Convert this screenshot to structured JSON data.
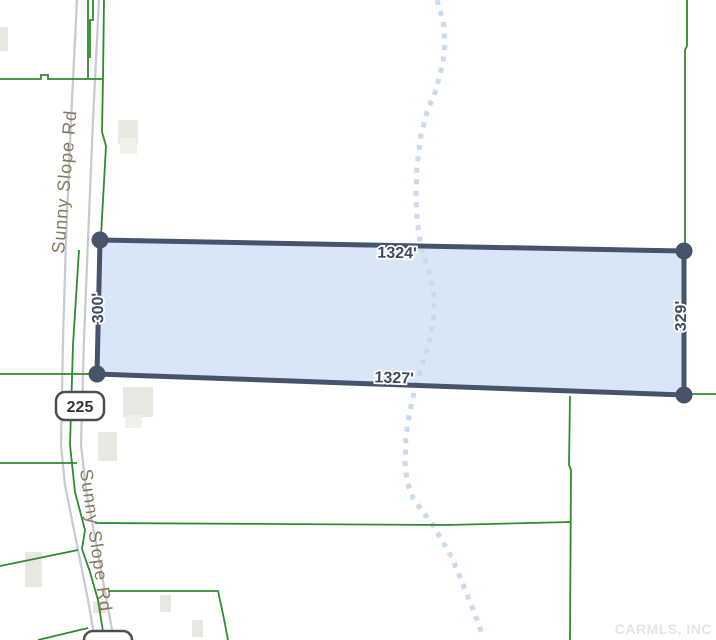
{
  "map_view": {
    "watermark": "CARMLS, INC",
    "parcel": {
      "dim_top": "1324'",
      "dim_bottom": "1327'",
      "dim_left": "300'",
      "dim_right": "329'"
    },
    "road": {
      "name_upper": "Sunny Slope Rd",
      "name_lower": "Sunny Slope Rd",
      "shield": "225",
      "shield_lower": "225"
    },
    "features": {
      "stream": "intermittent-stream-dotted-line",
      "boundaries": "green-parcel-boundary-lines",
      "buildings": "light-gray-building-footprints"
    },
    "colors": {
      "parcel_fill": "#d9e6f8",
      "parcel_border": "#46536b",
      "boundary_green": "#2e8b2e",
      "stream_blue": "#c9d8ec",
      "road_gray": "#c7c9d3",
      "dim_text": "#3d4a63",
      "road_text": "#85795e",
      "building_fill": "#e9e7e2",
      "watermark_gray": "#e4e4e4"
    }
  }
}
